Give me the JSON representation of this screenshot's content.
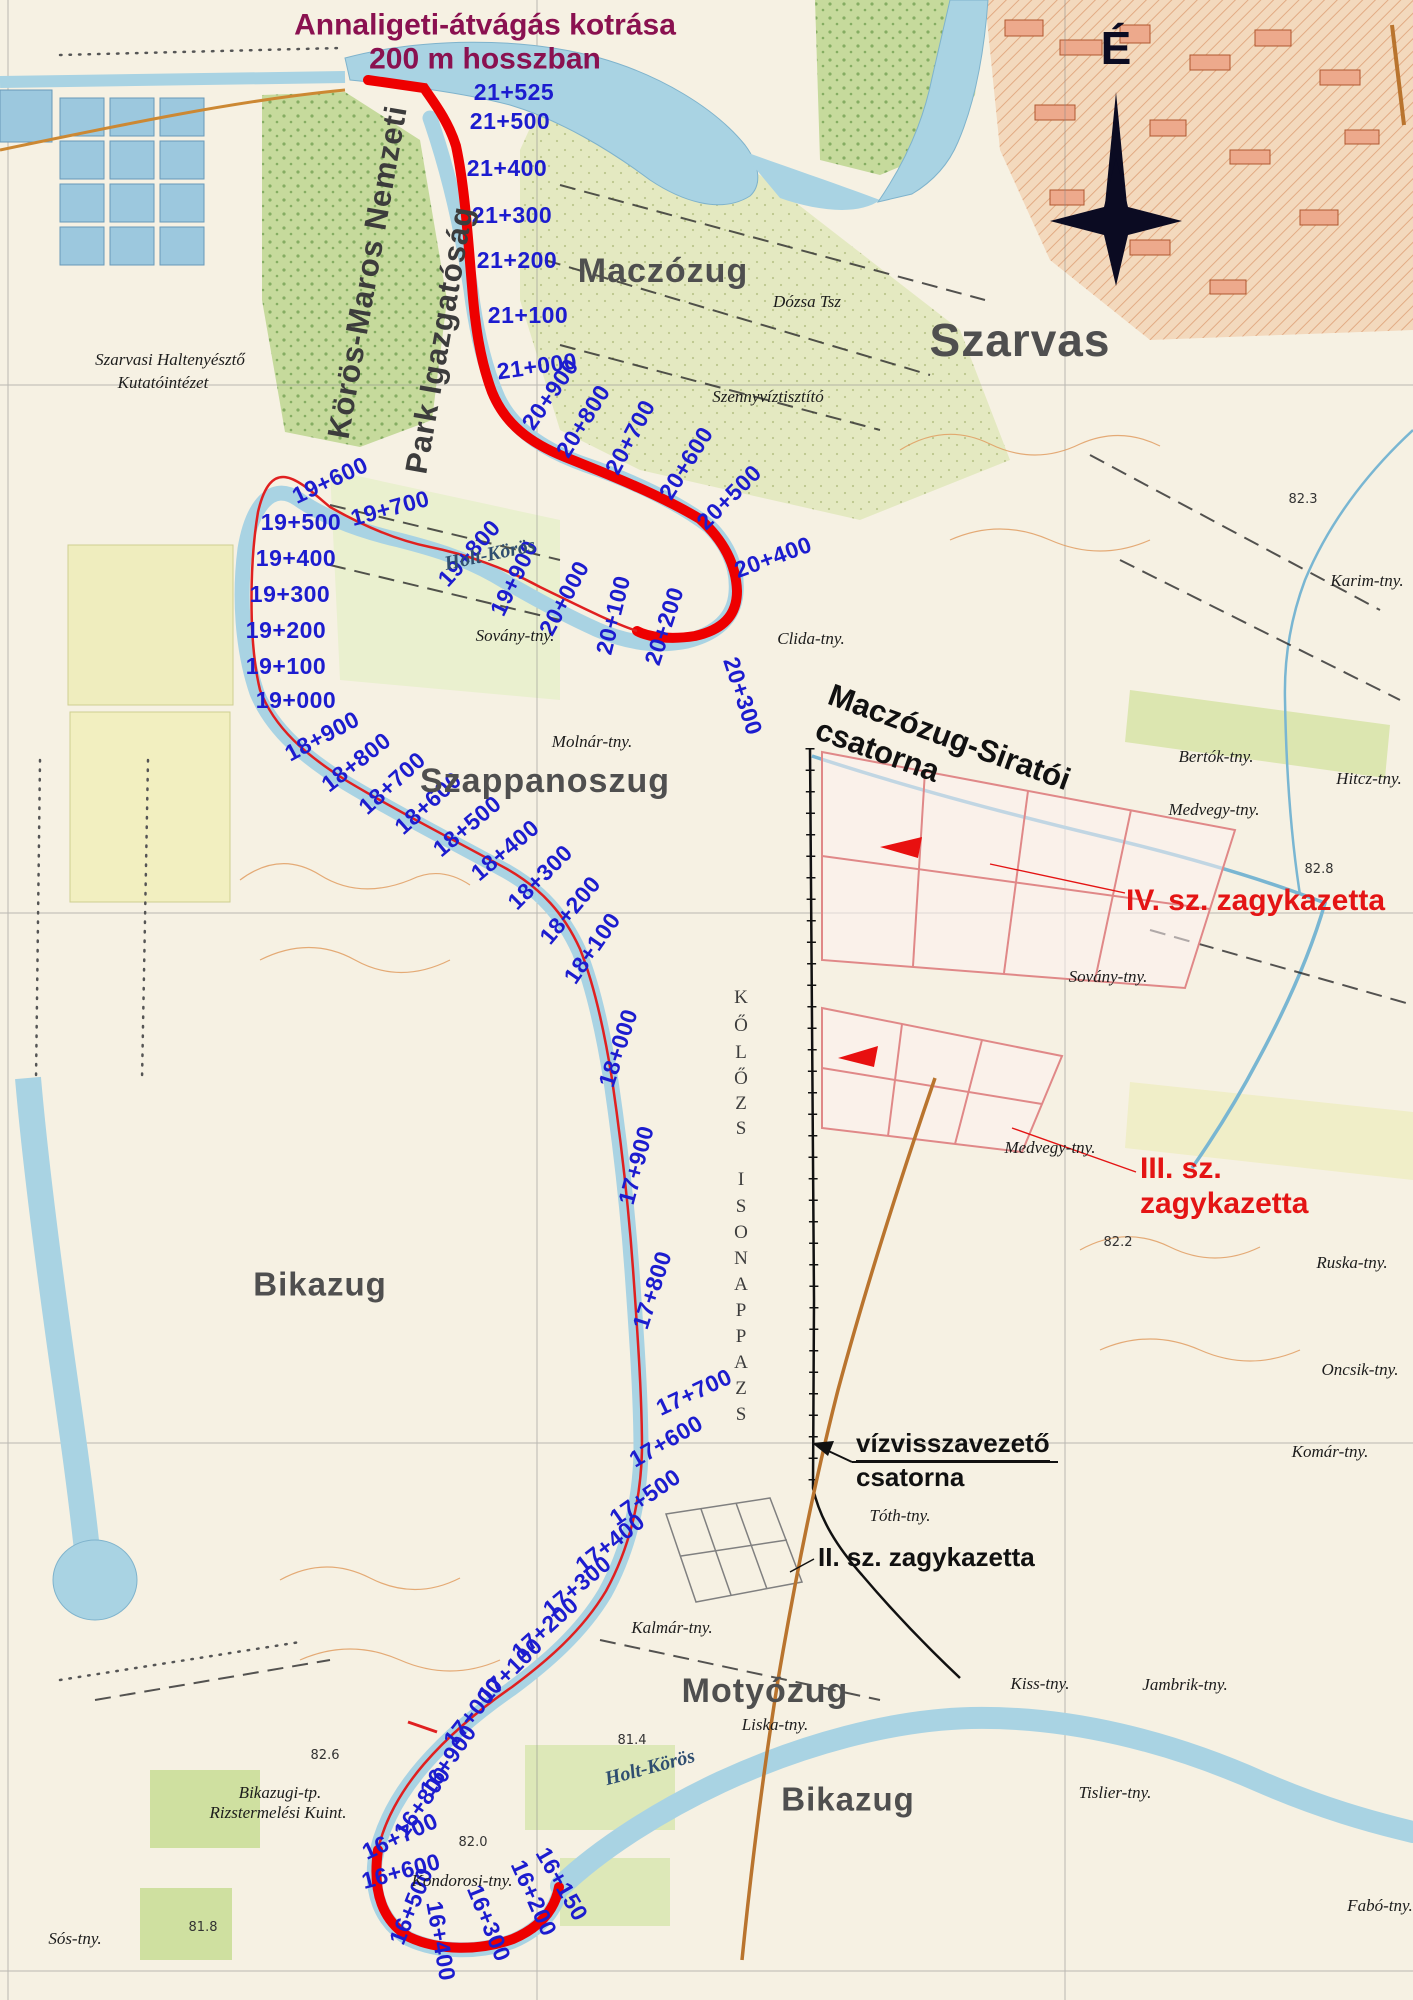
{
  "map": {
    "title": {
      "line1": "Annaligeti-átvágás kotrása",
      "line2": "200 m hosszban"
    },
    "north_label": "É",
    "colors": {
      "route_red": "#ee0000",
      "chainage_blue": "#1c1ccf",
      "annotation_red": "#e41414",
      "title_purple": "#8a1150",
      "water": "#a9d3e3",
      "cassette_pink": "#e08888"
    },
    "org_labels": [
      {
        "text": "Körös-Maros Nemzeti",
        "x": 368,
        "y": 272,
        "rot": -80
      },
      {
        "text": "Park Igazgatóság",
        "x": 440,
        "y": 340,
        "rot": -80
      }
    ],
    "area_labels": [
      {
        "text": "Maczózug",
        "x": 663,
        "y": 272,
        "size": 34,
        "rot": 0
      },
      {
        "text": "Szarvas",
        "x": 1020,
        "y": 340,
        "size": 46,
        "rot": 0
      },
      {
        "text": "Szappanoszug",
        "x": 545,
        "y": 782,
        "size": 34,
        "rot": 0
      },
      {
        "text": "Bikazug",
        "x": 320,
        "y": 1285,
        "size": 33,
        "rot": 0
      },
      {
        "text": "Motyózug",
        "x": 765,
        "y": 1692,
        "size": 34,
        "rot": 0
      },
      {
        "text": "Bikazug",
        "x": 848,
        "y": 1800,
        "size": 33,
        "rot": 0
      }
    ],
    "river_labels": [
      {
        "text": "Holt-Körös",
        "x": 490,
        "y": 555,
        "rot": -12
      },
      {
        "text": "Holt-Körös",
        "x": 650,
        "y": 1768,
        "rot": -15
      }
    ],
    "chainage_labels": [
      {
        "t": "21+525",
        "x": 514,
        "y": 92,
        "r": 0
      },
      {
        "t": "21+500",
        "x": 510,
        "y": 121,
        "r": 0
      },
      {
        "t": "21+400",
        "x": 507,
        "y": 168,
        "r": 0
      },
      {
        "t": "21+300",
        "x": 512,
        "y": 215,
        "r": 0
      },
      {
        "t": "21+200",
        "x": 517,
        "y": 260,
        "r": 0
      },
      {
        "t": "21+100",
        "x": 528,
        "y": 315,
        "r": 0
      },
      {
        "t": "21+000",
        "x": 537,
        "y": 366,
        "r": -8
      },
      {
        "t": "20+900",
        "x": 550,
        "y": 394,
        "r": -55
      },
      {
        "t": "20+800",
        "x": 583,
        "y": 421,
        "r": -58
      },
      {
        "t": "20+700",
        "x": 630,
        "y": 437,
        "r": -62
      },
      {
        "t": "20+600",
        "x": 686,
        "y": 463,
        "r": -58
      },
      {
        "t": "20+500",
        "x": 729,
        "y": 497,
        "r": -45
      },
      {
        "t": "20+400",
        "x": 773,
        "y": 557,
        "r": -20
      },
      {
        "t": "20+300",
        "x": 743,
        "y": 696,
        "r": 72
      },
      {
        "t": "20+200",
        "x": 664,
        "y": 626,
        "r": -72
      },
      {
        "t": "20+100",
        "x": 613,
        "y": 615,
        "r": -76
      },
      {
        "t": "20+000",
        "x": 564,
        "y": 598,
        "r": -62
      },
      {
        "t": "19+900",
        "x": 514,
        "y": 578,
        "r": -64
      },
      {
        "t": "19+800",
        "x": 469,
        "y": 553,
        "r": -48
      },
      {
        "t": "19+700",
        "x": 390,
        "y": 508,
        "r": -15
      },
      {
        "t": "19+600",
        "x": 330,
        "y": 480,
        "r": -25
      },
      {
        "t": "19+500",
        "x": 301,
        "y": 522,
        "r": 0
      },
      {
        "t": "19+400",
        "x": 296,
        "y": 558,
        "r": 0
      },
      {
        "t": "19+300",
        "x": 290,
        "y": 594,
        "r": 0
      },
      {
        "t": "19+200",
        "x": 286,
        "y": 630,
        "r": 0
      },
      {
        "t": "19+100",
        "x": 286,
        "y": 666,
        "r": 0
      },
      {
        "t": "19+000",
        "x": 296,
        "y": 700,
        "r": 0
      },
      {
        "t": "18+900",
        "x": 322,
        "y": 736,
        "r": -28
      },
      {
        "t": "18+800",
        "x": 356,
        "y": 762,
        "r": -38
      },
      {
        "t": "18+700",
        "x": 392,
        "y": 783,
        "r": -42
      },
      {
        "t": "18+600",
        "x": 428,
        "y": 803,
        "r": -42
      },
      {
        "t": "18+500",
        "x": 467,
        "y": 826,
        "r": -40
      },
      {
        "t": "18+400",
        "x": 505,
        "y": 850,
        "r": -40
      },
      {
        "t": "18+300",
        "x": 540,
        "y": 877,
        "r": -45
      },
      {
        "t": "18+200",
        "x": 570,
        "y": 910,
        "r": -50
      },
      {
        "t": "18+100",
        "x": 592,
        "y": 948,
        "r": -55
      },
      {
        "t": "18+000",
        "x": 618,
        "y": 1048,
        "r": -72
      },
      {
        "t": "17+900",
        "x": 636,
        "y": 1165,
        "r": -75
      },
      {
        "t": "17+800",
        "x": 652,
        "y": 1290,
        "r": -72
      },
      {
        "t": "17+700",
        "x": 694,
        "y": 1392,
        "r": -25
      },
      {
        "t": "17+600",
        "x": 666,
        "y": 1441,
        "r": -30
      },
      {
        "t": "17+500",
        "x": 645,
        "y": 1497,
        "r": -35
      },
      {
        "t": "17+400",
        "x": 610,
        "y": 1543,
        "r": -38
      },
      {
        "t": "17+300",
        "x": 577,
        "y": 1586,
        "r": -40
      },
      {
        "t": "17+200",
        "x": 545,
        "y": 1628,
        "r": -42
      },
      {
        "t": "17+100",
        "x": 510,
        "y": 1670,
        "r": -45
      },
      {
        "t": "17+000",
        "x": 473,
        "y": 1712,
        "r": -52
      },
      {
        "t": "16+900",
        "x": 448,
        "y": 1760,
        "r": -55
      },
      {
        "t": "16+800",
        "x": 422,
        "y": 1802,
        "r": -55
      },
      {
        "t": "16+700",
        "x": 400,
        "y": 1836,
        "r": -25
      },
      {
        "t": "16+600",
        "x": 401,
        "y": 1871,
        "r": -15
      },
      {
        "t": "16+500",
        "x": 411,
        "y": 1906,
        "r": -68
      },
      {
        "t": "16+400",
        "x": 441,
        "y": 1941,
        "r": 80
      },
      {
        "t": "16+300",
        "x": 489,
        "y": 1923,
        "r": 68
      },
      {
        "t": "16+200",
        "x": 534,
        "y": 1898,
        "r": 66
      },
      {
        "t": "16+150",
        "x": 562,
        "y": 1884,
        "r": 60
      }
    ],
    "red_annotations": [
      {
        "lines": [
          "IV. sz. zagykazetta"
        ],
        "x": 1126,
        "y": 884,
        "size": 30,
        "rot": 0
      },
      {
        "lines": [
          "III. sz.",
          "zagykazetta"
        ],
        "x": 1140,
        "y": 1152,
        "size": 30,
        "rot": 0
      }
    ],
    "black_annotations": [
      {
        "lines": [
          "Maczózug-Siratói",
          "csatorna"
        ],
        "x": 836,
        "y": 676,
        "size": 31,
        "rot": 20,
        "underline_first": false
      },
      {
        "lines": [
          "vízvisszavezető",
          "csatorna"
        ],
        "x": 856,
        "y": 1428,
        "size": 26,
        "rot": 0,
        "underline_first": true
      },
      {
        "lines": [
          "II. sz. zagykazetta"
        ],
        "x": 818,
        "y": 1542,
        "size": 26,
        "rot": 0,
        "underline_first": false
      }
    ],
    "tanya_labels": [
      {
        "text": "Szarvasi Haltenyésztő",
        "x": 170,
        "y": 360
      },
      {
        "text": "Kutatóintézet",
        "x": 163,
        "y": 383
      },
      {
        "text": "Dózsa Tsz",
        "x": 807,
        "y": 302
      },
      {
        "text": "Szennyvíztisztító",
        "x": 768,
        "y": 397
      },
      {
        "text": "Karim-tny.",
        "x": 1367,
        "y": 581
      },
      {
        "text": "Sovány-tny.",
        "x": 515,
        "y": 636
      },
      {
        "text": "Molnár-tny.",
        "x": 592,
        "y": 742
      },
      {
        "text": "Clida-tny.",
        "x": 811,
        "y": 639
      },
      {
        "text": "Bertók-tny.",
        "x": 1216,
        "y": 757
      },
      {
        "text": "Hitcz-tny.",
        "x": 1369,
        "y": 779
      },
      {
        "text": "Medvegy-tny.",
        "x": 1214,
        "y": 810
      },
      {
        "text": "Sovány-tny.",
        "x": 1108,
        "y": 977
      },
      {
        "text": "Medvegy-tny.",
        "x": 1050,
        "y": 1148
      },
      {
        "text": "Ruska-tny.",
        "x": 1352,
        "y": 1263
      },
      {
        "text": "Oncsik-tny.",
        "x": 1360,
        "y": 1370
      },
      {
        "text": "Komár-tny.",
        "x": 1330,
        "y": 1452
      },
      {
        "text": "Tóth-tny.",
        "x": 900,
        "y": 1516
      },
      {
        "text": "Kalmár-tny.",
        "x": 672,
        "y": 1628
      },
      {
        "text": "Liska-tny.",
        "x": 775,
        "y": 1725
      },
      {
        "text": "Kiss-tny.",
        "x": 1040,
        "y": 1684
      },
      {
        "text": "Jambrik-tny.",
        "x": 1185,
        "y": 1685
      },
      {
        "text": "Tislier-tny.",
        "x": 1115,
        "y": 1793
      },
      {
        "text": "Fabó-tny.",
        "x": 1380,
        "y": 1906
      },
      {
        "text": "Sós-tny.",
        "x": 75,
        "y": 1939
      },
      {
        "text": "Kondorosi-tny.",
        "x": 462,
        "y": 1881
      },
      {
        "text": "Bikazugi-tp.",
        "x": 280,
        "y": 1793
      },
      {
        "text": "Rizstermelési Kuint.",
        "x": 278,
        "y": 1813
      }
    ],
    "elevation_labels": [
      {
        "text": "82.3",
        "x": 1303,
        "y": 500
      },
      {
        "text": "82.8",
        "x": 1319,
        "y": 870
      },
      {
        "text": "82.2",
        "x": 1118,
        "y": 1243
      },
      {
        "text": "81.4",
        "x": 632,
        "y": 1741
      },
      {
        "text": "82.6",
        "x": 325,
        "y": 1756
      },
      {
        "text": "82.0",
        "x": 473,
        "y": 1843
      },
      {
        "text": "81.8",
        "x": 203,
        "y": 1928
      }
    ],
    "letter_column": [
      {
        "ch": "K",
        "x": 741,
        "y": 998
      },
      {
        "ch": "Ő",
        "x": 741,
        "y": 1026
      },
      {
        "ch": "L",
        "x": 741,
        "y": 1053
      },
      {
        "ch": "Ő",
        "x": 741,
        "y": 1079
      },
      {
        "ch": "Z",
        "x": 741,
        "y": 1104
      },
      {
        "ch": "S",
        "x": 741,
        "y": 1129
      },
      {
        "ch": "I",
        "x": 741,
        "y": 1180
      },
      {
        "ch": "S",
        "x": 741,
        "y": 1207
      },
      {
        "ch": "O",
        "x": 741,
        "y": 1233
      },
      {
        "ch": "N",
        "x": 741,
        "y": 1259
      },
      {
        "ch": "A",
        "x": 741,
        "y": 1285
      },
      {
        "ch": "P",
        "x": 741,
        "y": 1311
      },
      {
        "ch": "P",
        "x": 741,
        "y": 1337
      },
      {
        "ch": "A",
        "x": 741,
        "y": 1363
      },
      {
        "ch": "Z",
        "x": 741,
        "y": 1389
      },
      {
        "ch": "S",
        "x": 741,
        "y": 1415
      }
    ]
  }
}
